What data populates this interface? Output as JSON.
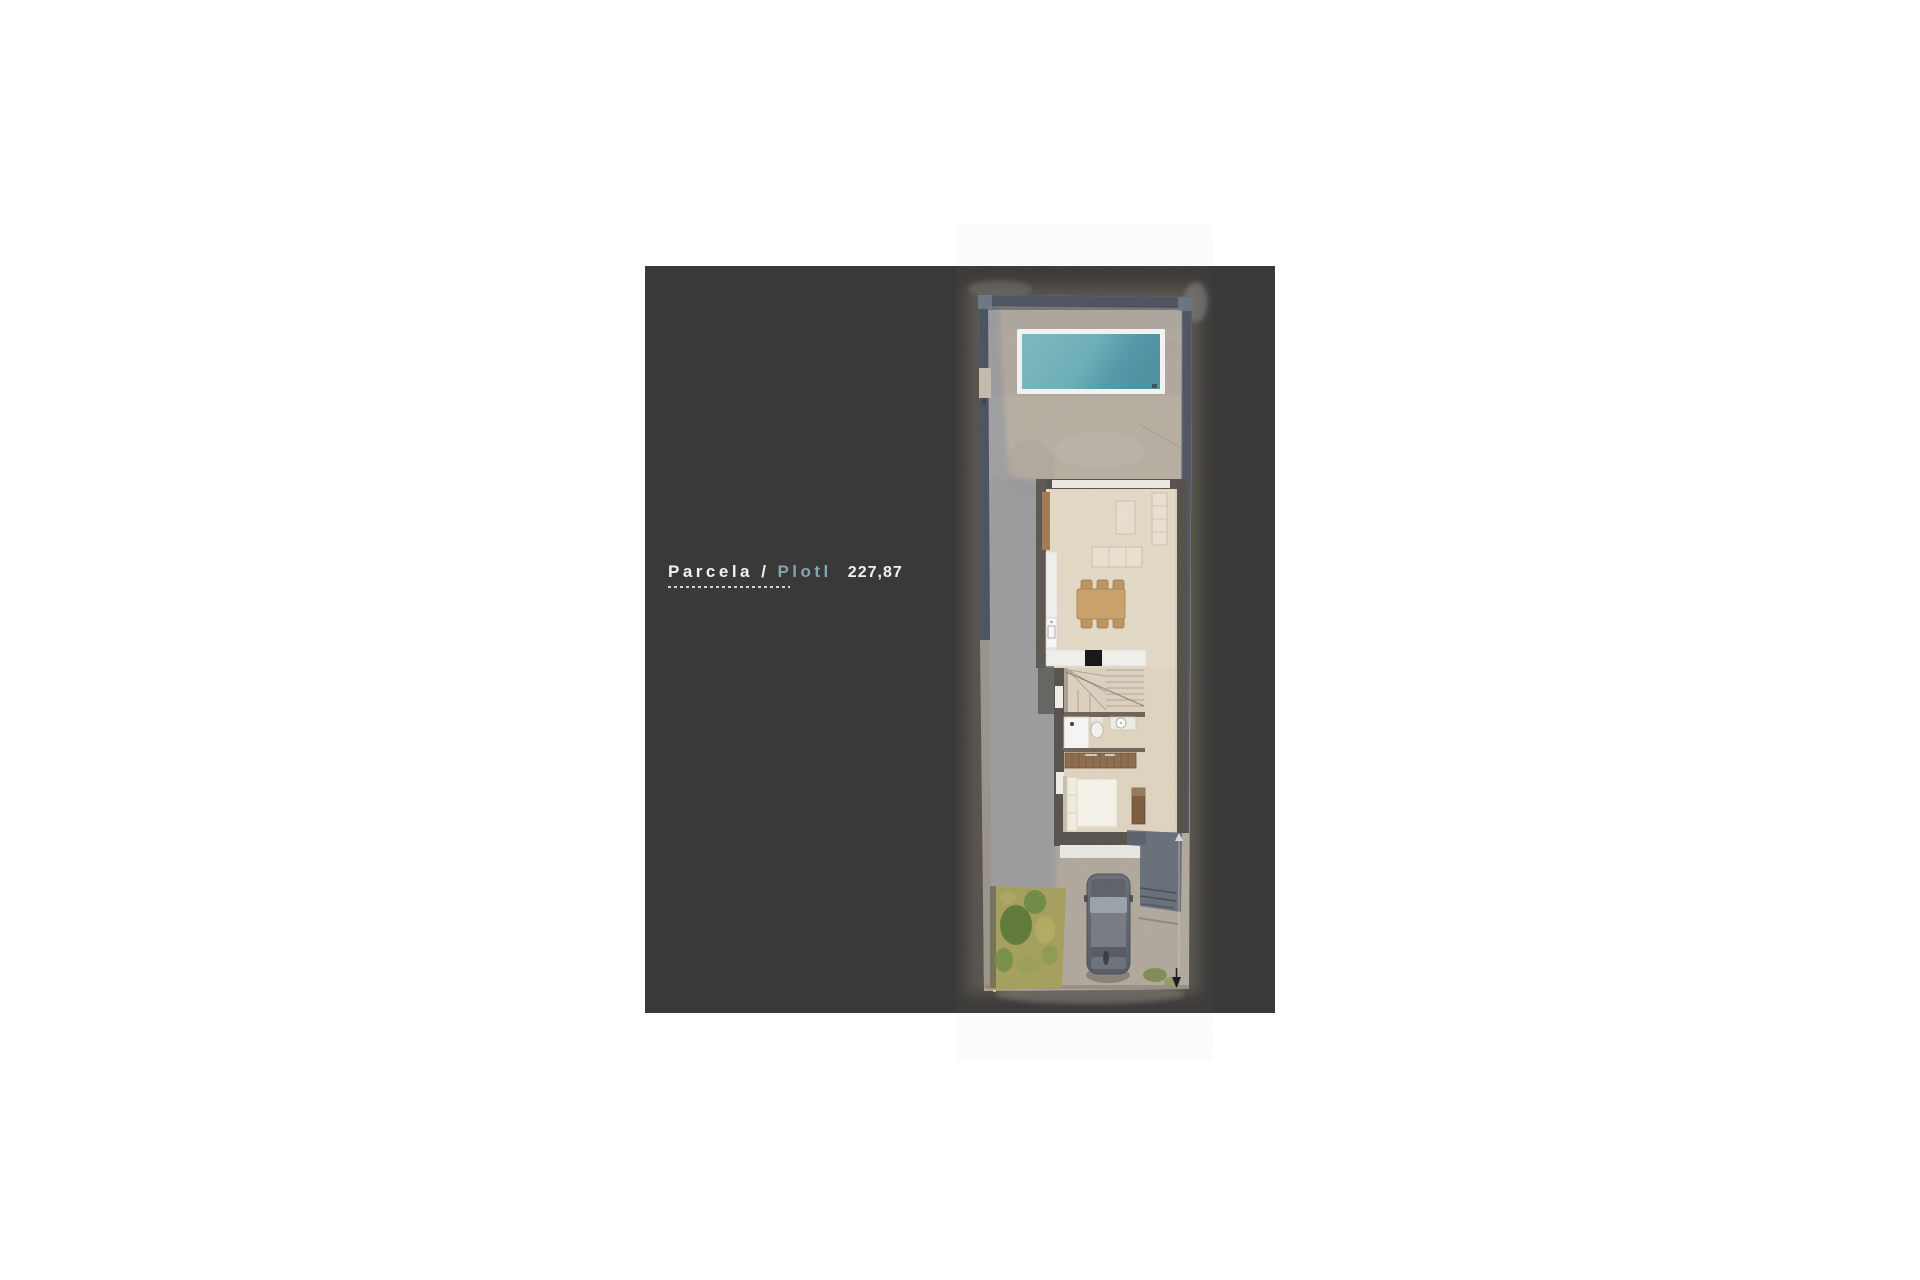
{
  "page": {
    "background": "#ffffff"
  },
  "panel": {
    "background": "#3a3938"
  },
  "title": {
    "label_primary": "Parcela /",
    "label_secondary": "Plotl",
    "area_value": "227,87",
    "primary_color": "#f2f1ef",
    "accent_color": "#82a5b2"
  },
  "site_plan": {
    "description": "aerial-top-view-of-narrow-plot-with-house-pool-car-and-garden",
    "features": [
      "boundary-wall",
      "swimming-pool",
      "terrace",
      "living-room",
      "sofa",
      "coffee-table",
      "dining-table",
      "kitchen",
      "cooktop",
      "staircase",
      "bathroom",
      "shower",
      "toilet",
      "vanity",
      "wardrobe",
      "bedroom",
      "bed",
      "desk",
      "patio-shadow",
      "driveway",
      "car",
      "garden",
      "entrance-arrow"
    ],
    "colors": {
      "concrete": "#b2a99e",
      "boundary_wall": "#4c5360",
      "house_wall": "#56524d",
      "floor": "#e4dac7",
      "pool_frame": "#f3f6f5",
      "pool_water": "#5f9fae",
      "wood": "#a47a52",
      "grass": "#6f8c44",
      "car_body": "#686d75",
      "shadow": "#8791a0"
    }
  }
}
